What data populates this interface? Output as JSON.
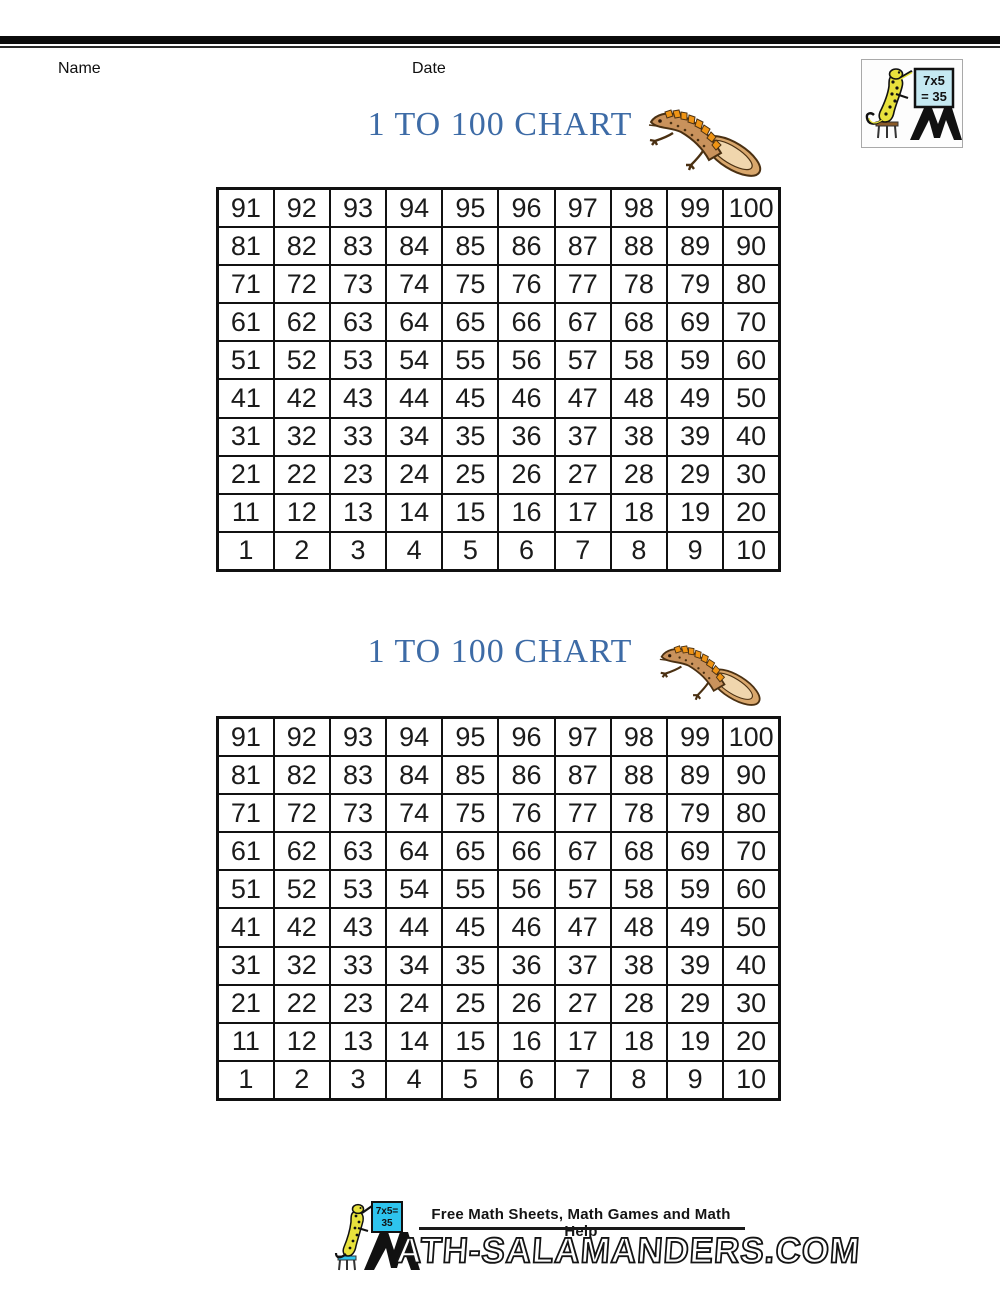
{
  "header": {
    "name_label": "Name",
    "date_label": "Date"
  },
  "corner_logo": {
    "board_line1": "7x5",
    "board_line2": "= 35",
    "m_letter": "M"
  },
  "charts": [
    {
      "title": "1 TO 100 CHART",
      "rows": [
        [
          91,
          92,
          93,
          94,
          95,
          96,
          97,
          98,
          99,
          100
        ],
        [
          81,
          82,
          83,
          84,
          85,
          86,
          87,
          88,
          89,
          90
        ],
        [
          71,
          72,
          73,
          74,
          75,
          76,
          77,
          78,
          79,
          80
        ],
        [
          61,
          62,
          63,
          64,
          65,
          66,
          67,
          68,
          69,
          70
        ],
        [
          51,
          52,
          53,
          54,
          55,
          56,
          57,
          58,
          59,
          60
        ],
        [
          41,
          42,
          43,
          44,
          45,
          46,
          47,
          48,
          49,
          50
        ],
        [
          31,
          32,
          33,
          34,
          35,
          36,
          37,
          38,
          39,
          40
        ],
        [
          21,
          22,
          23,
          24,
          25,
          26,
          27,
          28,
          29,
          30
        ],
        [
          11,
          12,
          13,
          14,
          15,
          16,
          17,
          18,
          19,
          20
        ],
        [
          1,
          2,
          3,
          4,
          5,
          6,
          7,
          8,
          9,
          10
        ]
      ]
    },
    {
      "title": "1 TO 100 CHART",
      "rows": [
        [
          91,
          92,
          93,
          94,
          95,
          96,
          97,
          98,
          99,
          100
        ],
        [
          81,
          82,
          83,
          84,
          85,
          86,
          87,
          88,
          89,
          90
        ],
        [
          71,
          72,
          73,
          74,
          75,
          76,
          77,
          78,
          79,
          80
        ],
        [
          61,
          62,
          63,
          64,
          65,
          66,
          67,
          68,
          69,
          70
        ],
        [
          51,
          52,
          53,
          54,
          55,
          56,
          57,
          58,
          59,
          60
        ],
        [
          41,
          42,
          43,
          44,
          45,
          46,
          47,
          48,
          49,
          50
        ],
        [
          31,
          32,
          33,
          34,
          35,
          36,
          37,
          38,
          39,
          40
        ],
        [
          21,
          22,
          23,
          24,
          25,
          26,
          27,
          28,
          29,
          30
        ],
        [
          11,
          12,
          13,
          14,
          15,
          16,
          17,
          18,
          19,
          20
        ],
        [
          1,
          2,
          3,
          4,
          5,
          6,
          7,
          8,
          9,
          10
        ]
      ]
    }
  ],
  "footer": {
    "tagline": "Free Math Sheets, Math Games and Math Help",
    "brand_text": "ATH-SALAMANDERS.COM",
    "board_line1": "7x5=",
    "board_line2": "35",
    "m_letter": "M"
  },
  "colors": {
    "title_blue": "#3d6ba6",
    "grid_border": "#111111",
    "newt_body": "#c9925c",
    "newt_stripe": "#ef9415",
    "newt_tail_inner": "#f0d6ad",
    "gecko_yellow": "#e8e23c",
    "corner_board_blue": "#c5e9f2",
    "footer_board_cyan": "#2ec4ee",
    "top_bar_black": "#0c0c0c"
  }
}
